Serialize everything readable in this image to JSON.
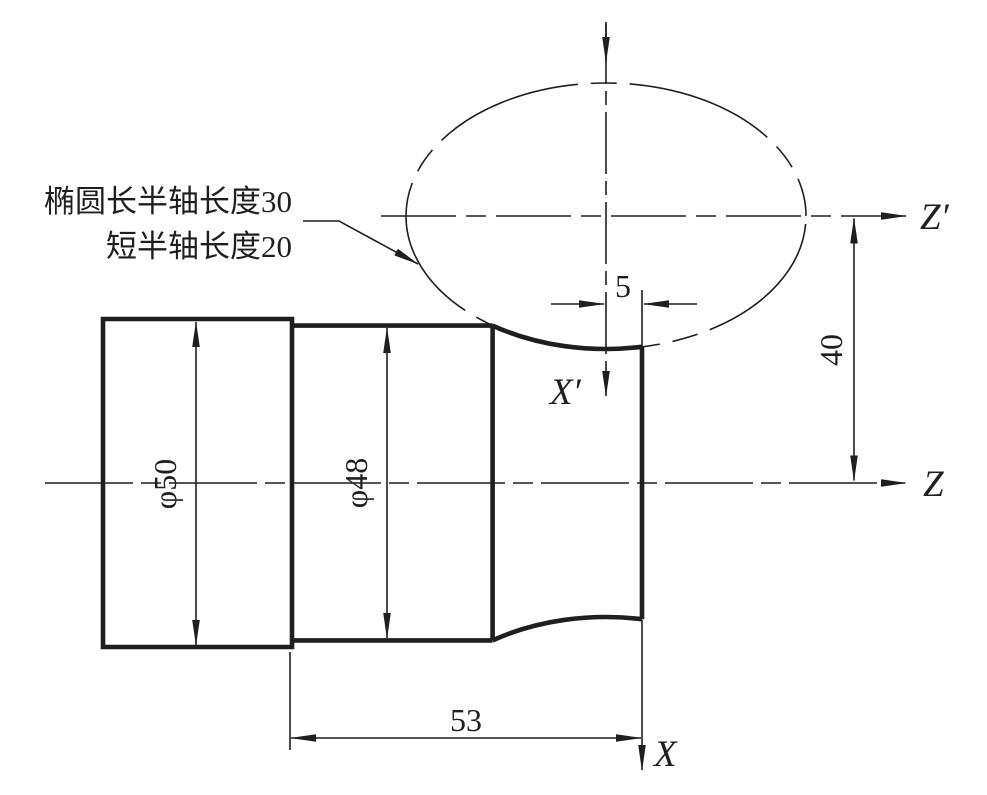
{
  "page": {
    "background": "#ffffff",
    "ink": "#1f1f1f"
  },
  "annotation": {
    "line1": "椭圆长半轴长度30",
    "line2": "短半轴长度20"
  },
  "dimensions": {
    "diameter_50": "φ50",
    "diameter_48": "φ48",
    "length_53": "53",
    "offset_5": "5",
    "height_40": "40"
  },
  "axes": {
    "z_prime": "Z′",
    "z": "Z",
    "x_prime": "X′",
    "x": "X"
  },
  "drawing_values": {
    "ellipse_major_semi_axis": 30,
    "ellipse_minor_semi_axis": 20,
    "ellipse_center_to_right_face": 5,
    "auxiliary_axis_distance": 40,
    "section_length": 53,
    "diameters": [
      50,
      48
    ]
  }
}
